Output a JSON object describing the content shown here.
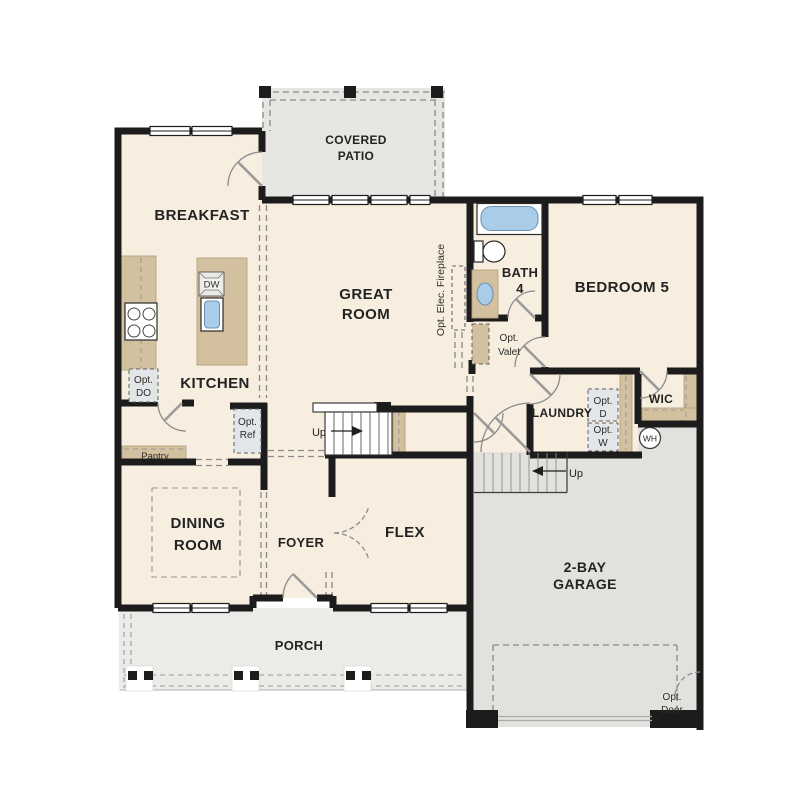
{
  "floor_plan": {
    "rooms": {
      "covered_patio": {
        "line1": "COVERED",
        "line2": "PATIO"
      },
      "breakfast": {
        "label": "BREAKFAST"
      },
      "great_room": {
        "line1": "GREAT",
        "line2": "ROOM"
      },
      "bath_4": {
        "line1": "BATH",
        "line2": "4"
      },
      "bedroom_5": {
        "label": "BEDROOM 5"
      },
      "kitchen": {
        "label": "KITCHEN"
      },
      "pantry": {
        "label": "Pantry"
      },
      "laundry": {
        "label": "LAUNDRY"
      },
      "wic": {
        "label": "WIC"
      },
      "dining_room": {
        "line1": "DINING",
        "line2": "ROOM"
      },
      "foyer": {
        "label": "FOYER"
      },
      "flex": {
        "label": "FLEX"
      },
      "garage": {
        "line1": "2-BAY",
        "line2": "GARAGE"
      },
      "porch": {
        "label": "PORCH"
      }
    },
    "annotations": {
      "opt_double_oven": {
        "line1": "Opt.",
        "line2": "DO"
      },
      "opt_refrigerator": {
        "line1": "Opt.",
        "line2": "Ref"
      },
      "opt_valet": {
        "line1": "Opt.",
        "line2": "Valet"
      },
      "opt_dryer": {
        "line1": "Opt.",
        "line2": "D"
      },
      "opt_washer": {
        "line1": "Opt.",
        "line2": "W"
      },
      "opt_garage_door": {
        "line1": "Opt.",
        "line2": "Door"
      },
      "opt_elec_fireplace": {
        "label": "Opt. Elec. Fireplace"
      },
      "dishwasher": {
        "label": "DW"
      },
      "water_heater": {
        "label": "WH"
      },
      "stairs_main": {
        "label": "Up"
      },
      "stairs_garage": {
        "label": "Up"
      }
    },
    "colors": {
      "background": "#ffffff",
      "interior_floor": "#f7eedf",
      "patio_floor": "#e8e6e2",
      "garage_floor": "#e3e1dd",
      "porch_floor": "#edebe8",
      "cabinet_tan": "#d2c09e",
      "wall_black": "#1c1c1c",
      "fixture_blue": "#a9cde8",
      "opt_box_gray": "#e2e6e8"
    }
  }
}
